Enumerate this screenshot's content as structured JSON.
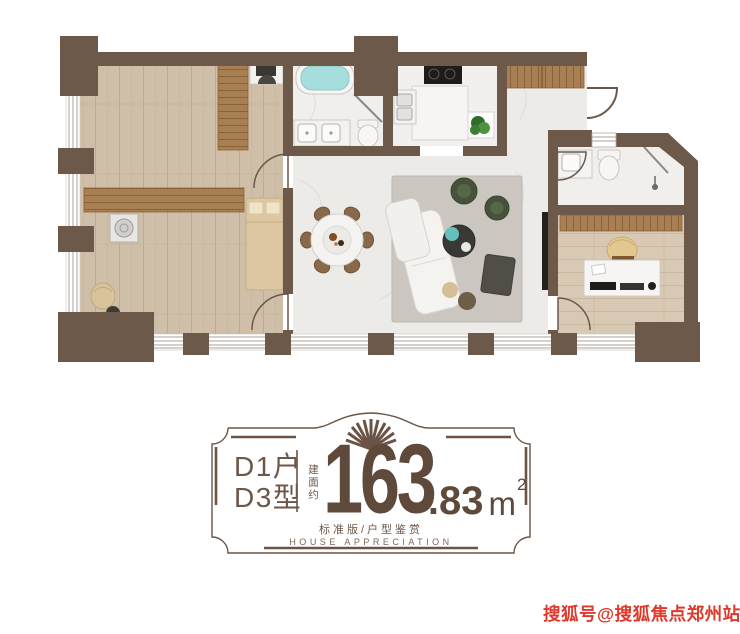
{
  "floor_plan": {
    "type": "apartment-floor-plan",
    "colors": {
      "wall": "#6d594a",
      "wood_floor": "#d0bfa8",
      "study_floor": "#d8c9b4",
      "cabinet_wood": "#a87f52",
      "marble": "#ecebe8",
      "rug": "#cbc7c0",
      "sofa_white": "#f4f3f0",
      "chair_green": "#46523a",
      "table_dark": "#3a3835",
      "water_teal": "#a5dedd",
      "plant_green": "#3f7d38"
    }
  },
  "badge": {
    "unit_line1": "D1户",
    "unit_line2": "D3型",
    "area_prefix": "建面约",
    "area_integer": "163",
    "area_decimal": ".83",
    "area_unit": "m",
    "area_unit_exponent": "2",
    "subtitle_cn": "标准版/户型鉴赏",
    "subtitle_en": "HOUSE APPRECIATION",
    "accent_color": "#6b5445"
  },
  "watermark": {
    "text": "搜狐号@搜狐焦点郑州站",
    "color": "#e0392c"
  }
}
